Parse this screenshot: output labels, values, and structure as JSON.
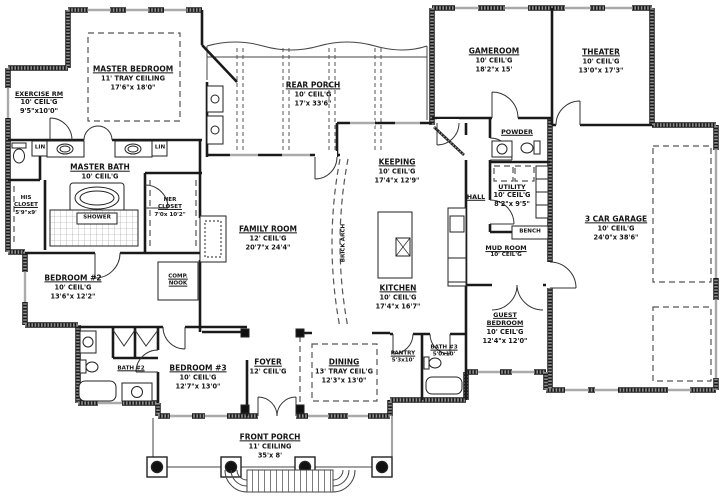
{
  "plan_title": "floor-plan",
  "labels": {
    "master_bedroom": {
      "l1": "MASTER BEDROOM",
      "l2": "11' TRAY CEILING",
      "l3": "17'6\"x 18'0\""
    },
    "exercise": {
      "l1": "EXERCISE RM",
      "l2": "10' CEIL'G",
      "l3": "9'5\"x10'0\""
    },
    "master_bath": {
      "l1": "MASTER BATH",
      "l2": "10' CEIL'G"
    },
    "rear_porch": {
      "l1": "REAR PORCH",
      "l2": "10' CEIL'G",
      "l3": "17'x 33'6\""
    },
    "gameroom": {
      "l1": "GAMEROOM",
      "l2": "10' CEIL'G",
      "l3": "18'2\"x 15'"
    },
    "theater": {
      "l1": "THEATER",
      "l2": "10' CEIL'G",
      "l3": "13'0\"x 17'3\""
    },
    "powder": {
      "l1": "POWDER"
    },
    "keeping": {
      "l1": "KEEPING",
      "l2": "10' CEIL'G",
      "l3": "17'4\"x 12'9\""
    },
    "utility": {
      "l1": "UTILITY",
      "l2": "10' CEIL'G",
      "l3": "8'2\"x 9'5\""
    },
    "hall": {
      "l1": "HALL"
    },
    "garage": {
      "l1": "3 CAR GARAGE",
      "l2": "10' CEIL'G",
      "l3": "24'0\"x 38'6\""
    },
    "family_room": {
      "l1": "FAMILY ROOM",
      "l2": "12' CEIL'G",
      "l3": "20'7\"x 24'4\""
    },
    "his_closet": {
      "l1": "HIS",
      "l2": "CLOSET",
      "l3": "5'9\"x9'"
    },
    "her_closet": {
      "l1": "HER",
      "l2": "CLOSET",
      "l3": "7'0x 10'2\""
    },
    "shower": {
      "l1": "SHOWER"
    },
    "lin_left": {
      "l1": "LIN"
    },
    "lin_right": {
      "l1": "LIN"
    },
    "bench": {
      "l1": "BENCH"
    },
    "mud_room": {
      "l1": "MUD ROOM",
      "l2": "10' CEIL'G"
    },
    "bedroom2": {
      "l1": "BEDROOM #2",
      "l2": "10' CEIL'G",
      "l3": "13'6\"x 12'2\""
    },
    "comp_nook": {
      "l1": "COMP.",
      "l2": "NOOK"
    },
    "kitchen": {
      "l1": "KITCHEN",
      "l2": "10' CEIL'G",
      "l3": "17'4\"x 16'7\""
    },
    "guest_bedroom": {
      "l1": "GUEST",
      "l2": "BEDROOM",
      "l3": "10' CEIL'G",
      "l4": "12'4\"x 12'0\""
    },
    "bedroom3": {
      "l1": "BEDROOM #3",
      "l2": "10' CEIL'G",
      "l3": "12'7\"x 13'0\""
    },
    "bath2": {
      "l1": "BATH #2"
    },
    "foyer": {
      "l1": "FOYER",
      "l2": "12' CEIL'G"
    },
    "dining": {
      "l1": "DINING",
      "l2": "13' TRAY CEIL'G",
      "l3": "12'3\"x 13'0\""
    },
    "pantry": {
      "l1": "PANTRY",
      "l2": "5'3x10'"
    },
    "bath3": {
      "l1": "BATH #3",
      "l2": "5'0x10'"
    },
    "front_porch": {
      "l1": "FRONT PORCH",
      "l2": "11' CEILING",
      "l3": "35'x 8'"
    },
    "brick_arch": {
      "l1": "BRICK ARCH"
    }
  },
  "colors": {
    "wall": "#1a1a1a",
    "hatch": "#8f8f8f",
    "dash": "#555555",
    "window": "#aaaaaa"
  }
}
